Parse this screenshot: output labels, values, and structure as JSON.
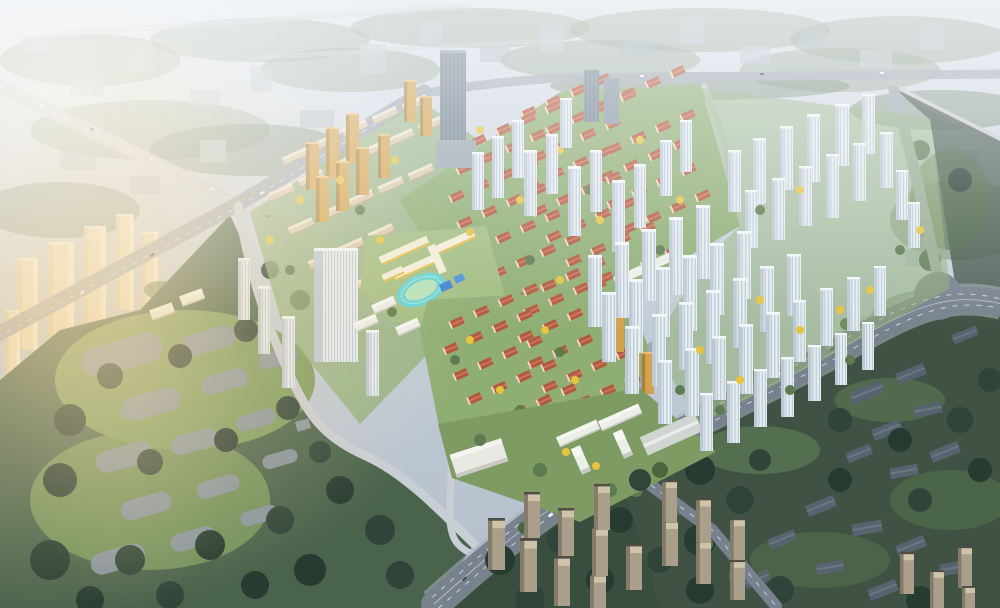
{
  "scene": {
    "type": "aerial-architectural-rendering",
    "subject": "bird's-eye masterplan rendering of a large residential development: red-roof low-rise villages, white high-rise tower clusters, a school campus with cyan running track, arterial roads with traffic, a tree-filled park with gray pads, hazy existing city in the background",
    "lighting": "hazy daylight, warm sun glow from the left edge, darker shadowed ground at lower right",
    "visible_text": "none"
  },
  "palette": {
    "sky-top": "#dbe2ea",
    "sky-low": "#b8c3cf",
    "haze-white": "#f6f8fa",
    "sun-glow": "#f7d9a2",
    "bg-building": "#bac4cf",
    "bg-building-dark": "#a2aebb",
    "bg-tree": "#8a9c85",
    "bg-tree-dark": "#6d8370",
    "road-light": "#c9cdd4",
    "road-mid": "#a0a8b3",
    "road-inner": "#c3c9d1",
    "avenue": "#78828f",
    "sidewalk": "#aab3bd",
    "lane": "#eceff2",
    "median-yellow": "#d9b545",
    "site-lawn": "#8fae74",
    "school-lawn": "#a2bd82",
    "tree-green": "#5c7b50",
    "tree-mid": "#49663f",
    "tree-dark": "#2f4539",
    "tree-park": "#273c31",
    "tree-yellow": "#e5c43e",
    "park-base": "#4a634c",
    "park-lawn": "#7d9c60",
    "pad-gray": "#8b96a3",
    "roof-red": "#b2593f",
    "roof-red-light": "#cd7a59",
    "house-wall": "#ecdcc2",
    "slab-wall": "#d9cbae",
    "slab-roof": "#eee5cf",
    "slab-shade": "#b5a687",
    "white-wall": "#eceee8",
    "white-roof": "#f6f7f3",
    "tower-white": "#e8edf2",
    "tower-shade": "#bcc8d3",
    "tower-window": "#9db2c2",
    "tower-cap": "#f4f7fa",
    "office-gray": "#7e8c9a",
    "office-stripe": "#64737e",
    "office-cap": "#95a3ae",
    "amber": "#d2a24e",
    "amber-shade": "#ab7f37",
    "amber-light": "#e9c276",
    "track-cyan": "#63d2d2",
    "track-infield": "#b5e2b9",
    "court-blue": "#3f7fd0",
    "school-yellow": "#e4bb3f",
    "school-white": "#f2eed9",
    "beige-wall": "#a99f8b",
    "beige-light": "#cfc3a9",
    "beige-shade": "#857b69",
    "beige-roof": "#4f4b45",
    "slate-bldg": "#57646f",
    "slate-ridge": "#6b7882",
    "dark-zone": "#3f5244",
    "dark-zone2": "#3a4e40",
    "cream-tower": "#ecdebf",
    "cream-light": "#f8efd9",
    "cream-shade": "#d9c6a2",
    "warehouse": "#cfd6d2",
    "warehouse-ridge": "#e8ecea",
    "car-light": "#f2f5f7",
    "car-dark": "#454d55"
  },
  "regions": [
    {
      "id": "background-city",
      "desc": "hazy existing city blocks, tree bands and highways, upper third"
    },
    {
      "id": "left-sunlit-towers",
      "desc": "cream existing towers in warm glow, left edge"
    },
    {
      "id": "district-west-midrise",
      "desc": "beige mid-rise slab district with white towers, center-left"
    },
    {
      "id": "village-north",
      "desc": "red-roof low-rise village, upper center"
    },
    {
      "id": "school-campus",
      "desc": "school with yellow-trimmed buildings, cyan running track, blue courts, center"
    },
    {
      "id": "village-south",
      "desc": "red-roof low-rise village, lower center"
    },
    {
      "id": "campus-south",
      "desc": "white office/school blocks and gable hall near main avenue"
    },
    {
      "id": "cluster-top",
      "desc": "white towers, dark office high-rise, amber towers, top center"
    },
    {
      "id": "cluster-right",
      "desc": "large white-and-glass residential tower field, right half"
    },
    {
      "id": "central-park",
      "desc": "dense tree park with gray pads, bottom left"
    },
    {
      "id": "dark-southeast",
      "desc": "shadowed trees, slate context buildings, tan tower estates, bottom right"
    },
    {
      "id": "main-avenue",
      "desc": "wide diagonal arterial with traffic crossing bottom right"
    }
  ]
}
